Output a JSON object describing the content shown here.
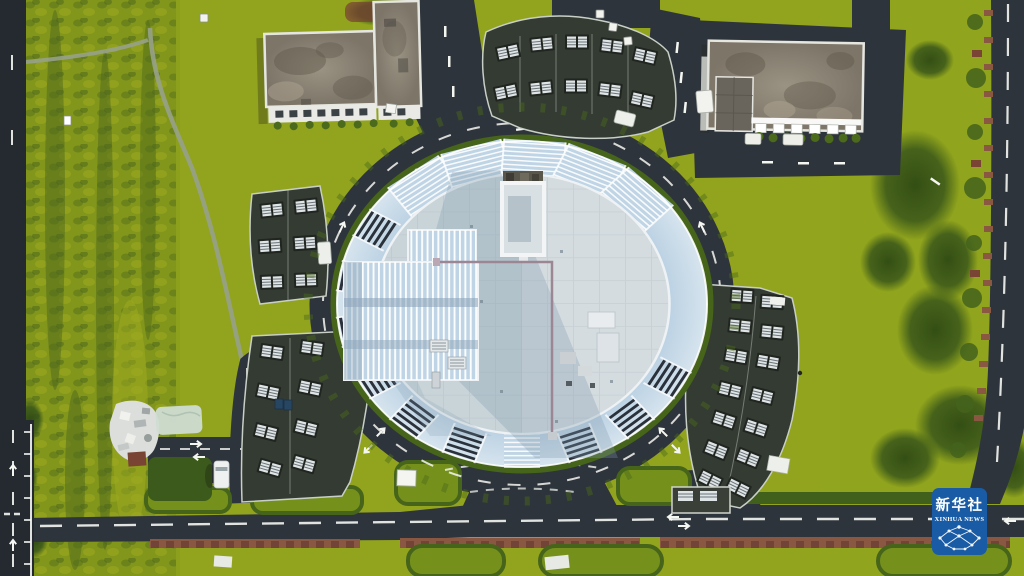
{
  "watermark": {
    "title_cn": "新华社",
    "title_en": "XINHUA NEWS",
    "icon": "network-globe-icon"
  },
  "colors": {
    "grass_base": "#8CA01D",
    "grass_light": "#A2AC23",
    "grass_band": "#82961B",
    "grass_dark": "#75911C",
    "shrub_dark": "#4E681B",
    "tree_dark": "#2F4A13",
    "hedge": "#46651A",
    "asphalt": "#2E343B",
    "asphalt_dark": "#252A30",
    "marking_white": "#F4F6F2",
    "red_path": "#8A5743",
    "red_path_dark": "#6B4034",
    "red_shrub": "#7A4434",
    "glass_blue": "#BFD4E4",
    "glass_edge": "#D6E4EE",
    "louver_dark": "#2A313B",
    "atrium_blue": "#3D5875",
    "ring_white": "#EEF2F5",
    "roof_base": "#C9D4D9",
    "roof_bright": "#DAE1E4",
    "roof_shadow": "#7E99AC",
    "roof_inner_shadow": "#B6C2CA",
    "pipe": "#9C8694",
    "cluster_roof": "#343B33",
    "cluster_edge": "#C8CFC6",
    "unit_dark": "#20251F",
    "unit_white": "#DFE4E6",
    "unit_stripe": "#6B7478",
    "weathered": "#8D8678",
    "weathered_dark": "#5F584C",
    "weathered_light": "#ADA391",
    "facade_white": "#E9EAE5",
    "window_dark": "#3A4246",
    "courtyard_dark": "#6A655C",
    "path_gray": "#97A189",
    "debris_white": "#DCDEDB",
    "tarp_green": "#CFDCD2",
    "van_white": "#EFF1F1",
    "bin_blue": "#274661",
    "watermark_blue": "#195CA5",
    "white": "#FFFFFF"
  }
}
